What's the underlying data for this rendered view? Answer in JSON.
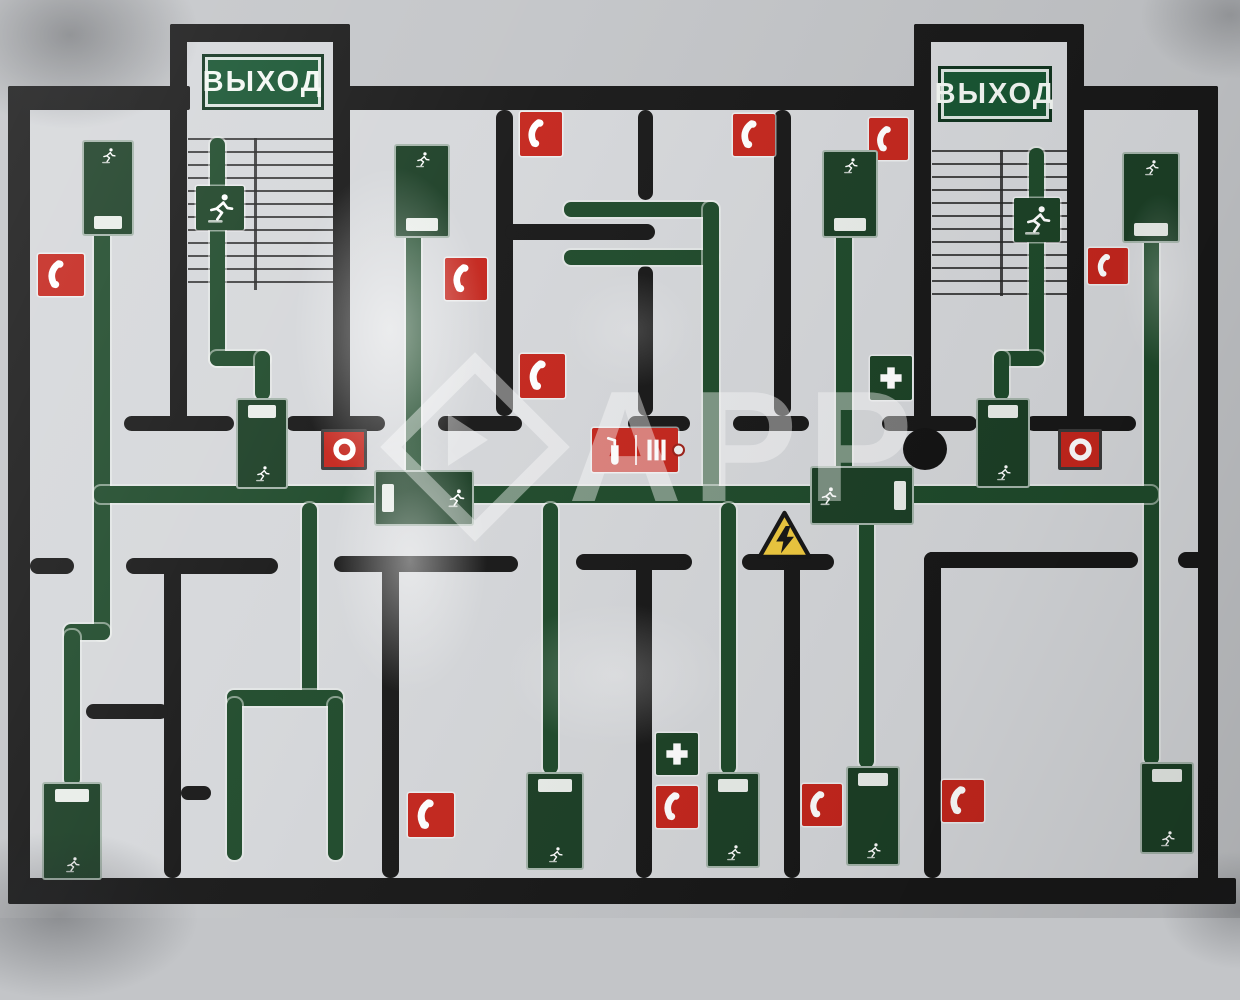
{
  "labels": {
    "exit": "ВЫХОД",
    "watermark": "АРР"
  },
  "colors": {
    "board": "#c3c5c8",
    "paper": "#d5d7da",
    "wall": "#181818",
    "route_green": "#1f4a2b",
    "device_green": "#1c3f26",
    "sign_green": "#175431",
    "safety_red": "#c4261d",
    "hazard_yellow": "#eec83e",
    "white": "#f3f7f3"
  },
  "plan": {
    "width": 1240,
    "height": 918,
    "paper": [
      [
        30,
        110,
        1168,
        768
      ],
      [
        187,
        42,
        146,
        68
      ],
      [
        931,
        42,
        136,
        68
      ]
    ],
    "walls": [
      [
        8,
        86,
        22,
        816,
        2
      ],
      [
        8,
        86,
        182,
        24,
        2
      ],
      [
        334,
        86,
        592,
        24,
        2
      ],
      [
        1070,
        86,
        148,
        24,
        2
      ],
      [
        8,
        878,
        1228,
        26,
        2
      ],
      [
        1198,
        86,
        20,
        818,
        2
      ],
      [
        170,
        24,
        180,
        18,
        2
      ],
      [
        170,
        24,
        17,
        398,
        2
      ],
      [
        333,
        24,
        17,
        398,
        2
      ],
      [
        914,
        24,
        170,
        18,
        2
      ],
      [
        914,
        24,
        17,
        398,
        2
      ],
      [
        1067,
        24,
        17,
        398,
        2
      ],
      [
        124,
        416,
        110,
        15
      ],
      [
        286,
        416,
        99,
        15
      ],
      [
        438,
        416,
        84,
        15
      ],
      [
        628,
        416,
        62,
        15
      ],
      [
        733,
        416,
        76,
        15
      ],
      [
        882,
        416,
        95,
        15
      ],
      [
        1026,
        416,
        110,
        15
      ],
      [
        496,
        110,
        17,
        306
      ],
      [
        638,
        110,
        15,
        90
      ],
      [
        638,
        266,
        15,
        150
      ],
      [
        774,
        110,
        17,
        306
      ],
      [
        505,
        224,
        150,
        16
      ],
      [
        30,
        558,
        44,
        16
      ],
      [
        126,
        558,
        152,
        16
      ],
      [
        164,
        558,
        17,
        320
      ],
      [
        86,
        704,
        82,
        15
      ],
      [
        181,
        786,
        30,
        14
      ],
      [
        334,
        556,
        184,
        16
      ],
      [
        382,
        556,
        17,
        322
      ],
      [
        576,
        554,
        116,
        16
      ],
      [
        636,
        554,
        16,
        324
      ],
      [
        742,
        554,
        92,
        16
      ],
      [
        784,
        554,
        16,
        324
      ],
      [
        924,
        552,
        17,
        326
      ],
      [
        924,
        552,
        214,
        16
      ],
      [
        1178,
        552,
        40,
        16
      ]
    ],
    "stairs": [
      {
        "x": 188,
        "y": 138,
        "w": 146,
        "h": 152,
        "step": 13,
        "divider": 66
      },
      {
        "x": 932,
        "y": 150,
        "w": 136,
        "h": 146,
        "step": 13,
        "divider": 68
      }
    ],
    "routes": [
      [
        94,
        216,
        16,
        424
      ],
      [
        64,
        624,
        46,
        16
      ],
      [
        64,
        630,
        16,
        156
      ],
      [
        210,
        138,
        15,
        228
      ],
      [
        210,
        351,
        60,
        15
      ],
      [
        255,
        351,
        15,
        49
      ],
      [
        255,
        474,
        15,
        15
      ],
      [
        406,
        220,
        15,
        271
      ],
      [
        564,
        202,
        154,
        15
      ],
      [
        564,
        250,
        154,
        15
      ],
      [
        703,
        202,
        16,
        289
      ],
      [
        836,
        222,
        16,
        269
      ],
      [
        1029,
        148,
        15,
        218
      ],
      [
        994,
        351,
        50,
        15
      ],
      [
        994,
        351,
        15,
        49
      ],
      [
        994,
        473,
        15,
        16
      ],
      [
        1144,
        228,
        15,
        537
      ],
      [
        94,
        486,
        1064,
        17
      ],
      [
        302,
        503,
        15,
        198
      ],
      [
        227,
        690,
        116,
        16
      ],
      [
        227,
        698,
        15,
        162
      ],
      [
        328,
        698,
        15,
        162
      ],
      [
        543,
        503,
        15,
        271
      ],
      [
        721,
        503,
        15,
        271
      ],
      [
        859,
        503,
        15,
        265
      ]
    ],
    "icons": [
      {
        "t": "exit",
        "x": 202,
        "y": 54,
        "w": 122,
        "h": 56
      },
      {
        "t": "exit",
        "x": 938,
        "y": 66,
        "w": 114,
        "h": 56
      },
      {
        "t": "runsq",
        "x": 196,
        "y": 186,
        "w": 48,
        "h": 44
      },
      {
        "t": "runsq",
        "x": 1014,
        "y": 198,
        "w": 46,
        "h": 44
      },
      {
        "t": "phone",
        "x": 38,
        "y": 254,
        "w": 46,
        "h": 42
      },
      {
        "t": "phone",
        "x": 520,
        "y": 112,
        "w": 42,
        "h": 44
      },
      {
        "t": "phone",
        "x": 733,
        "y": 114,
        "w": 42,
        "h": 42
      },
      {
        "t": "phone",
        "x": 869,
        "y": 118,
        "w": 39,
        "h": 42
      },
      {
        "t": "phone",
        "x": 445,
        "y": 258,
        "w": 42,
        "h": 42
      },
      {
        "t": "phone",
        "x": 520,
        "y": 354,
        "w": 45,
        "h": 44
      },
      {
        "t": "phone",
        "x": 1088,
        "y": 248,
        "w": 40,
        "h": 36
      },
      {
        "t": "phone",
        "x": 408,
        "y": 793,
        "w": 46,
        "h": 44
      },
      {
        "t": "phone",
        "x": 656,
        "y": 786,
        "w": 42,
        "h": 42
      },
      {
        "t": "phone",
        "x": 802,
        "y": 784,
        "w": 40,
        "h": 42
      },
      {
        "t": "phone",
        "x": 942,
        "y": 780,
        "w": 42,
        "h": 42
      },
      {
        "t": "hose",
        "x": 321,
        "y": 429,
        "w": 46,
        "h": 41
      },
      {
        "t": "hose",
        "x": 1058,
        "y": 429,
        "w": 44,
        "h": 41
      },
      {
        "t": "combo",
        "x": 592,
        "y": 428,
        "w": 86,
        "h": 44
      },
      {
        "t": "aid",
        "x": 870,
        "y": 356,
        "w": 42,
        "h": 44
      },
      {
        "t": "aid",
        "x": 656,
        "y": 733,
        "w": 42,
        "h": 42
      },
      {
        "t": "hazard",
        "x": 753,
        "y": 511,
        "w": 62,
        "h": 49
      },
      {
        "t": "column",
        "x": 903,
        "y": 428,
        "w": 44,
        "h": 42
      },
      {
        "t": "dev",
        "x": 82,
        "y": 140,
        "w": 40,
        "h": 82,
        "strip": "bottom"
      },
      {
        "t": "dev",
        "x": 394,
        "y": 144,
        "w": 44,
        "h": 80,
        "strip": "bottom"
      },
      {
        "t": "dev",
        "x": 236,
        "y": 398,
        "w": 40,
        "h": 77,
        "strip": "top"
      },
      {
        "t": "dev",
        "x": 822,
        "y": 150,
        "w": 44,
        "h": 74,
        "strip": "bottom"
      },
      {
        "t": "dev",
        "x": 976,
        "y": 398,
        "w": 42,
        "h": 76,
        "strip": "top"
      },
      {
        "t": "dev",
        "x": 1122,
        "y": 152,
        "w": 46,
        "h": 77,
        "strip": "bottom"
      },
      {
        "t": "dev",
        "x": 42,
        "y": 782,
        "w": 48,
        "h": 84,
        "strip": "top"
      },
      {
        "t": "dev",
        "x": 526,
        "y": 772,
        "w": 46,
        "h": 84,
        "strip": "top"
      },
      {
        "t": "dev",
        "x": 706,
        "y": 772,
        "w": 42,
        "h": 82,
        "strip": "top"
      },
      {
        "t": "dev",
        "x": 846,
        "y": 766,
        "w": 42,
        "h": 86,
        "strip": "top"
      },
      {
        "t": "dev",
        "x": 1140,
        "y": 762,
        "w": 42,
        "h": 78,
        "strip": "top"
      },
      {
        "t": "hsign",
        "x": 374,
        "y": 470,
        "w": 84,
        "h": 44,
        "bar": "left"
      },
      {
        "t": "hsign",
        "x": 810,
        "y": 466,
        "w": 88,
        "h": 47,
        "bar": "right"
      }
    ],
    "overlays": [
      {
        "t": "glare",
        "x": 290,
        "y": 160,
        "w": 200,
        "h": 340,
        "o": 0.55
      },
      {
        "t": "glare",
        "x": 330,
        "y": 420,
        "w": 160,
        "h": 280,
        "o": 0.5
      },
      {
        "t": "glare",
        "x": 500,
        "y": 600,
        "w": 230,
        "h": 150,
        "o": 0.28
      },
      {
        "t": "glare",
        "x": 1120,
        "y": 190,
        "w": 80,
        "h": 180,
        "o": 0.25
      },
      {
        "t": "glare",
        "x": 560,
        "y": 270,
        "w": 140,
        "h": 120,
        "o": 0.2
      },
      {
        "t": "shade",
        "x": -60,
        "y": -60,
        "w": 260,
        "h": 190,
        "o": 0.45
      },
      {
        "t": "shade",
        "x": -80,
        "y": 830,
        "w": 280,
        "h": 170,
        "o": 0.4
      },
      {
        "t": "shade",
        "x": 1140,
        "y": -50,
        "w": 180,
        "h": 130,
        "o": 0.3
      },
      {
        "t": "shade",
        "x": 1160,
        "y": 850,
        "w": 160,
        "h": 120,
        "o": 0.3
      }
    ]
  }
}
